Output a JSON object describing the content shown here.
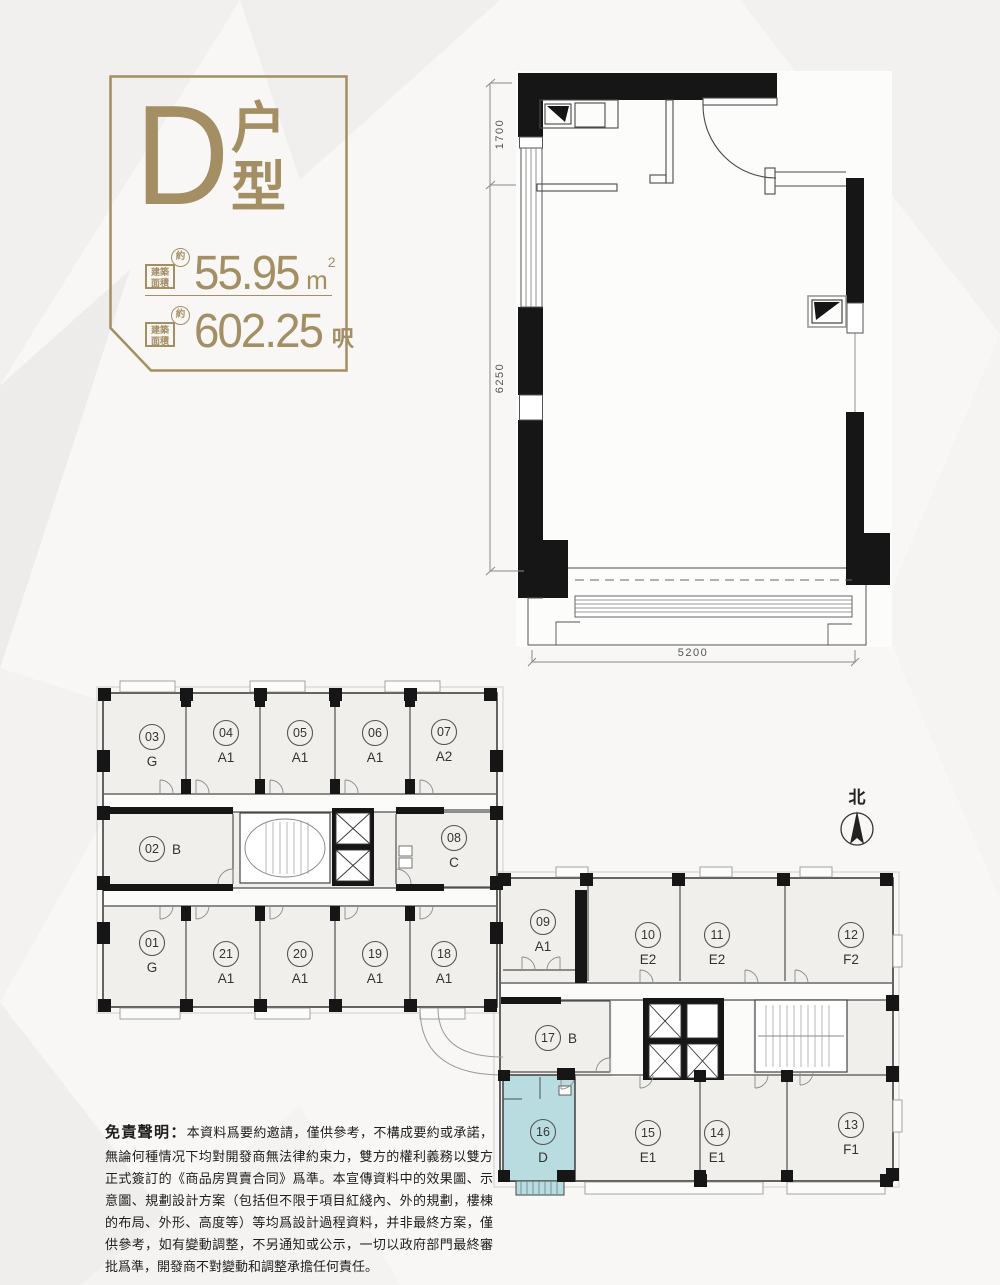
{
  "page": {
    "background": "#f8f7f5"
  },
  "title_block": {
    "accent_color": "#a48e63",
    "type_letter": "D",
    "type_word_line1": "户",
    "type_word_line2": "型",
    "area_rows": [
      {
        "label_l1": "建築",
        "label_l2": "面積",
        "approx": "約",
        "value": "55.95",
        "unit": "m",
        "unit_sup": "2"
      },
      {
        "label_l1": "建築",
        "label_l2": "面積",
        "approx": "約",
        "value": "602.25",
        "unit": "呎",
        "unit_sup": ""
      }
    ]
  },
  "unit_plan": {
    "dimensions": {
      "left_top": "1700",
      "left_main": "6250",
      "bottom": "5200"
    }
  },
  "floor_plate": {
    "highlight_color": "#b9dce0",
    "units": [
      {
        "number": "03",
        "type": "G"
      },
      {
        "number": "04",
        "type": "A1"
      },
      {
        "number": "05",
        "type": "A1"
      },
      {
        "number": "06",
        "type": "A1"
      },
      {
        "number": "07",
        "type": "A2"
      },
      {
        "number": "02",
        "type": "B"
      },
      {
        "number": "08",
        "type": "C"
      },
      {
        "number": "01",
        "type": "G"
      },
      {
        "number": "21",
        "type": "A1"
      },
      {
        "number": "20",
        "type": "A1"
      },
      {
        "number": "19",
        "type": "A1"
      },
      {
        "number": "18",
        "type": "A1"
      },
      {
        "number": "09",
        "type": "A1"
      },
      {
        "number": "10",
        "type": "E2"
      },
      {
        "number": "11",
        "type": "E2"
      },
      {
        "number": "12",
        "type": "F2"
      },
      {
        "number": "17",
        "type": "B"
      },
      {
        "number": "16",
        "type": "D",
        "highlighted": true
      },
      {
        "number": "15",
        "type": "E1"
      },
      {
        "number": "14",
        "type": "E1"
      },
      {
        "number": "13",
        "type": "F1"
      }
    ]
  },
  "north": {
    "label": "北"
  },
  "disclaimer": {
    "heading": "免責聲明：",
    "body": "本資料爲要約邀請，僅供參考，不構成要約或承諾，無論何種情况下均對開發商無法律約束力，雙方的權利義務以雙方正式簽訂的《商品房買賣合同》爲準。本宣傳資料中的效果圖、示意圖、規劃設計方案（包括但不限于項目紅綫內、外的規劃，樓棟的布局、外形、高度等）等均爲設計過程資料，并非最終方案，僅供參考，如有變動調整，不另通知或公示，一切以政府部門最終審批爲準，開發商不對變動和調整承擔任何責任。"
  }
}
